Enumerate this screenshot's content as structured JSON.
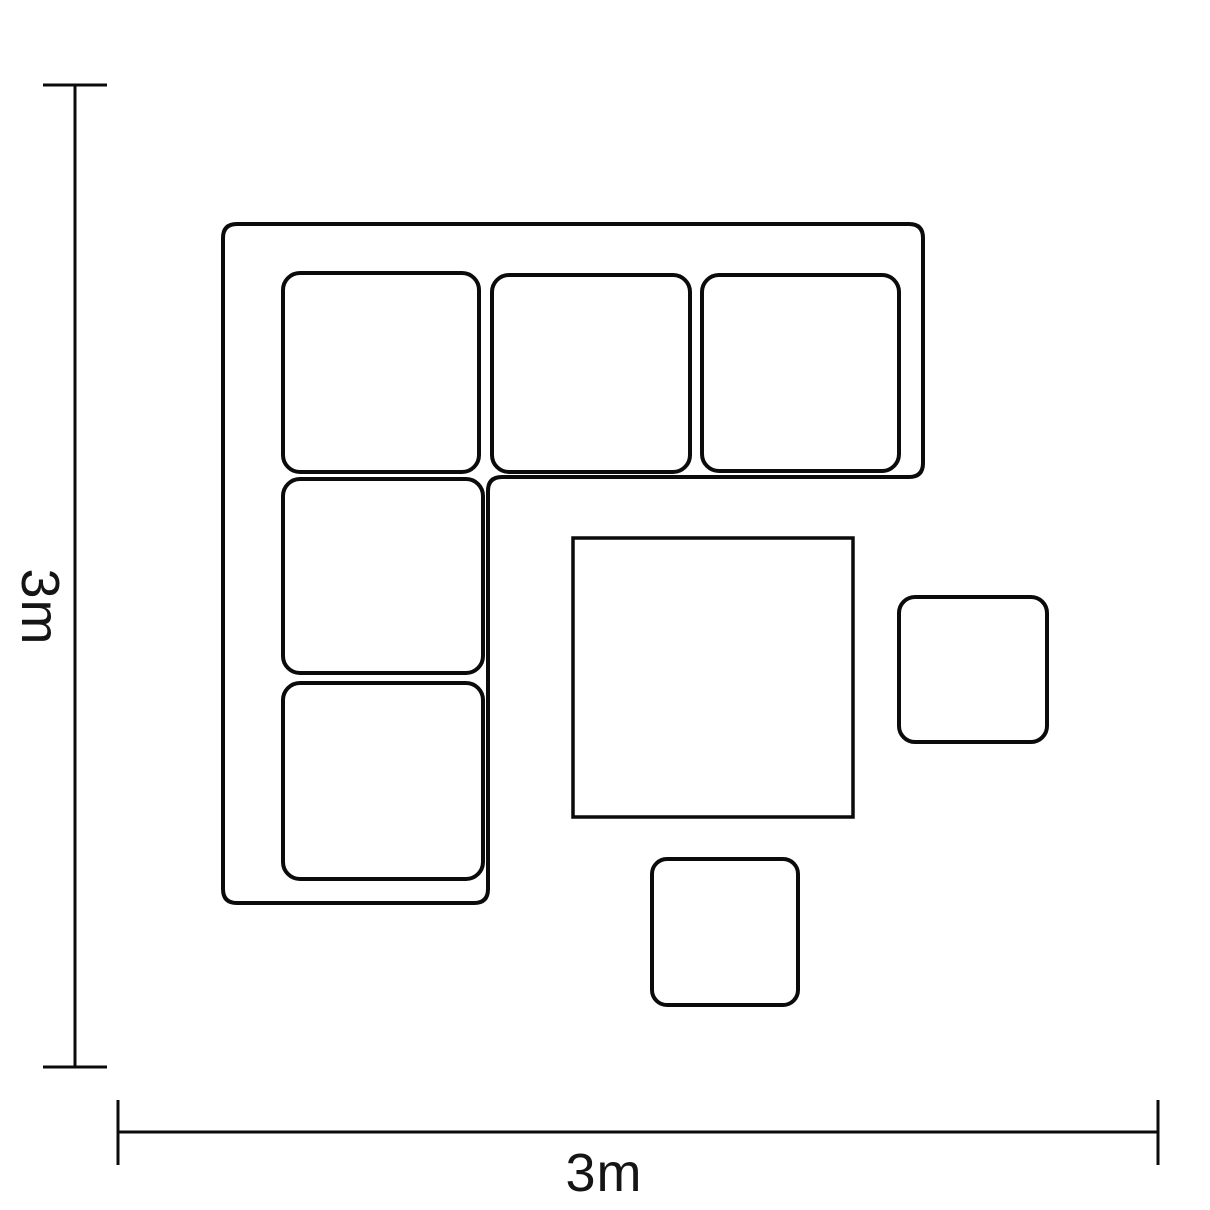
{
  "diagram": {
    "height_label": "3m",
    "width_label": "3m"
  },
  "colors": {
    "background": "#ffffff",
    "line": "#0b0b0b",
    "text": "#151515"
  }
}
